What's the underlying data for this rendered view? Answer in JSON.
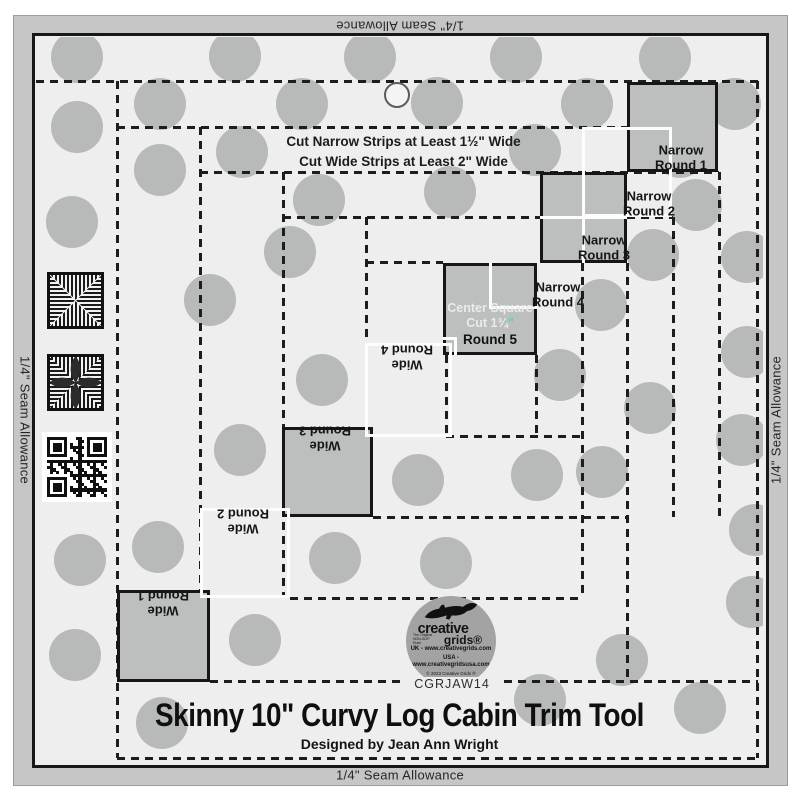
{
  "band": {
    "top": "1/4\" Seam Allowance",
    "bottom": "1/4\" Seam Allowance",
    "left": "1/4\" Seam Allowance",
    "right": "1/4\" Seam Allowance"
  },
  "instructions": {
    "line1": "Cut Narrow Strips at Least 1½\" Wide",
    "line2": "Cut Wide Strips at Least 2\" Wide"
  },
  "center": {
    "line1": "Center Square",
    "line2_text": "Cut 1¾",
    "line2_mark": "\"",
    "line3": "Round 5"
  },
  "rounds": {
    "narrow": [
      {
        "lines": [
          "Narrow",
          "Round 1"
        ],
        "x": 681,
        "y": 158
      },
      {
        "lines": [
          "Narrow",
          "Round 2"
        ],
        "x": 649,
        "y": 204
      },
      {
        "lines": [
          "Narrow",
          "Round 3"
        ],
        "x": 604,
        "y": 248
      },
      {
        "lines": [
          "Narrow",
          "Round 4"
        ],
        "x": 558,
        "y": 295
      }
    ],
    "wide": [
      {
        "lines": [
          "Wide",
          "Round 4"
        ],
        "x": 407,
        "y": 357
      },
      {
        "lines": [
          "Wide",
          "Round 3"
        ],
        "x": 325,
        "y": 438
      },
      {
        "lines": [
          "Wide",
          "Round 2"
        ],
        "x": 243,
        "y": 521
      },
      {
        "lines": [
          "Wide",
          "Round 1"
        ],
        "x": 163,
        "y": 603
      }
    ]
  },
  "footer": {
    "sku": "CGRJAW14",
    "title": "Skinny 10\" Curvy Log Cabin Trim Tool",
    "designer": "Designed by Jean Ann Wright"
  },
  "logo": {
    "brand_top": "creative",
    "brand_bottom": "grids®",
    "tagline": "The Original NON-SLIP Ruler",
    "uk": "UK - www.creativegrids.com",
    "usa": "USA - www.creativegridsusa.com",
    "copyright": "© 2023 Creative Grids ®",
    "made": "MADE IN USA"
  },
  "colors": {
    "band": "#c5c6c5",
    "interior": "#edeeed",
    "dot": "#b7bab8",
    "ink": "#1d1d1d",
    "square_fill": "#bcbfbd",
    "white": "#fdfdfd",
    "cyan": "#3fd8d8",
    "logo_circle": "#a2a3a2",
    "frame": "#171717"
  },
  "decor": {
    "dots": [
      [
        77,
        57
      ],
      [
        235,
        56
      ],
      [
        370,
        57
      ],
      [
        516,
        57
      ],
      [
        665,
        58
      ],
      [
        160,
        104
      ],
      [
        302,
        104
      ],
      [
        437,
        103
      ],
      [
        587,
        104
      ],
      [
        735,
        104
      ],
      [
        77,
        127
      ],
      [
        242,
        152
      ],
      [
        535,
        150
      ],
      [
        680,
        152
      ],
      [
        160,
        170
      ],
      [
        319,
        200
      ],
      [
        450,
        192
      ],
      [
        696,
        205
      ],
      [
        72,
        222
      ],
      [
        290,
        252
      ],
      [
        653,
        255
      ],
      [
        747,
        257
      ],
      [
        210,
        300
      ],
      [
        601,
        305
      ],
      [
        747,
        352
      ],
      [
        322,
        380
      ],
      [
        560,
        375
      ],
      [
        650,
        408
      ],
      [
        240,
        450
      ],
      [
        418,
        480
      ],
      [
        537,
        475
      ],
      [
        602,
        472
      ],
      [
        742,
        440
      ],
      [
        158,
        547
      ],
      [
        335,
        558
      ],
      [
        80,
        560
      ],
      [
        446,
        563
      ],
      [
        255,
        640
      ],
      [
        75,
        655
      ],
      [
        622,
        660
      ],
      [
        162,
        723
      ],
      [
        540,
        700
      ],
      [
        700,
        708
      ],
      [
        752,
        602
      ],
      [
        755,
        530
      ]
    ],
    "dashed_h": [
      [
        81,
        36,
        758
      ],
      [
        127,
        117,
        719
      ],
      [
        172,
        200,
        719
      ],
      [
        217,
        283,
        540
      ],
      [
        217,
        627,
        673
      ],
      [
        262,
        366,
        443
      ],
      [
        436,
        446,
        582
      ],
      [
        517,
        373,
        627
      ],
      [
        598,
        290,
        582
      ],
      [
        681,
        210,
        758
      ],
      [
        758,
        117,
        758
      ]
    ],
    "dashed_v": [
      [
        117,
        81,
        758
      ],
      [
        200,
        127,
        681
      ],
      [
        283,
        172,
        598
      ],
      [
        366,
        217,
        517
      ],
      [
        446,
        355,
        436
      ],
      [
        536,
        355,
        436
      ],
      [
        582,
        263,
        598
      ],
      [
        627,
        263,
        681
      ],
      [
        673,
        217,
        517
      ],
      [
        719,
        172,
        517
      ],
      [
        757,
        81,
        758
      ]
    ],
    "squares": [
      {
        "name": "narrow-round-1-square",
        "x": 627,
        "y": 82,
        "w": 91,
        "h": 90
      },
      {
        "name": "narrow-grid-square",
        "x": 540,
        "y": 172,
        "w": 87,
        "h": 91
      },
      {
        "name": "center-square",
        "x": 443,
        "y": 263,
        "w": 94,
        "h": 92
      },
      {
        "name": "wide-round-3-square",
        "x": 282,
        "y": 427,
        "w": 91,
        "h": 90
      },
      {
        "name": "wide-round-1-square",
        "x": 117,
        "y": 590,
        "w": 93,
        "h": 92
      }
    ],
    "white_rects": [
      {
        "x": 582,
        "y": 127,
        "w": 90,
        "h": 90
      },
      {
        "x": 365,
        "y": 343,
        "w": 87,
        "h": 94
      },
      {
        "x": 200,
        "y": 508,
        "w": 90,
        "h": 90
      }
    ],
    "white_segs": [
      {
        "x": 540,
        "y": 216,
        "w": 87,
        "h": 3
      },
      {
        "x": 582,
        "y": 172,
        "w": 3,
        "h": 91
      },
      {
        "x": 489,
        "y": 263,
        "w": 3,
        "h": 46
      },
      {
        "x": 489,
        "y": 306,
        "w": 48,
        "h": 3
      },
      {
        "x": 443,
        "y": 337,
        "w": 14,
        "h": 3
      },
      {
        "x": 454,
        "y": 337,
        "w": 3,
        "h": 18
      }
    ]
  }
}
